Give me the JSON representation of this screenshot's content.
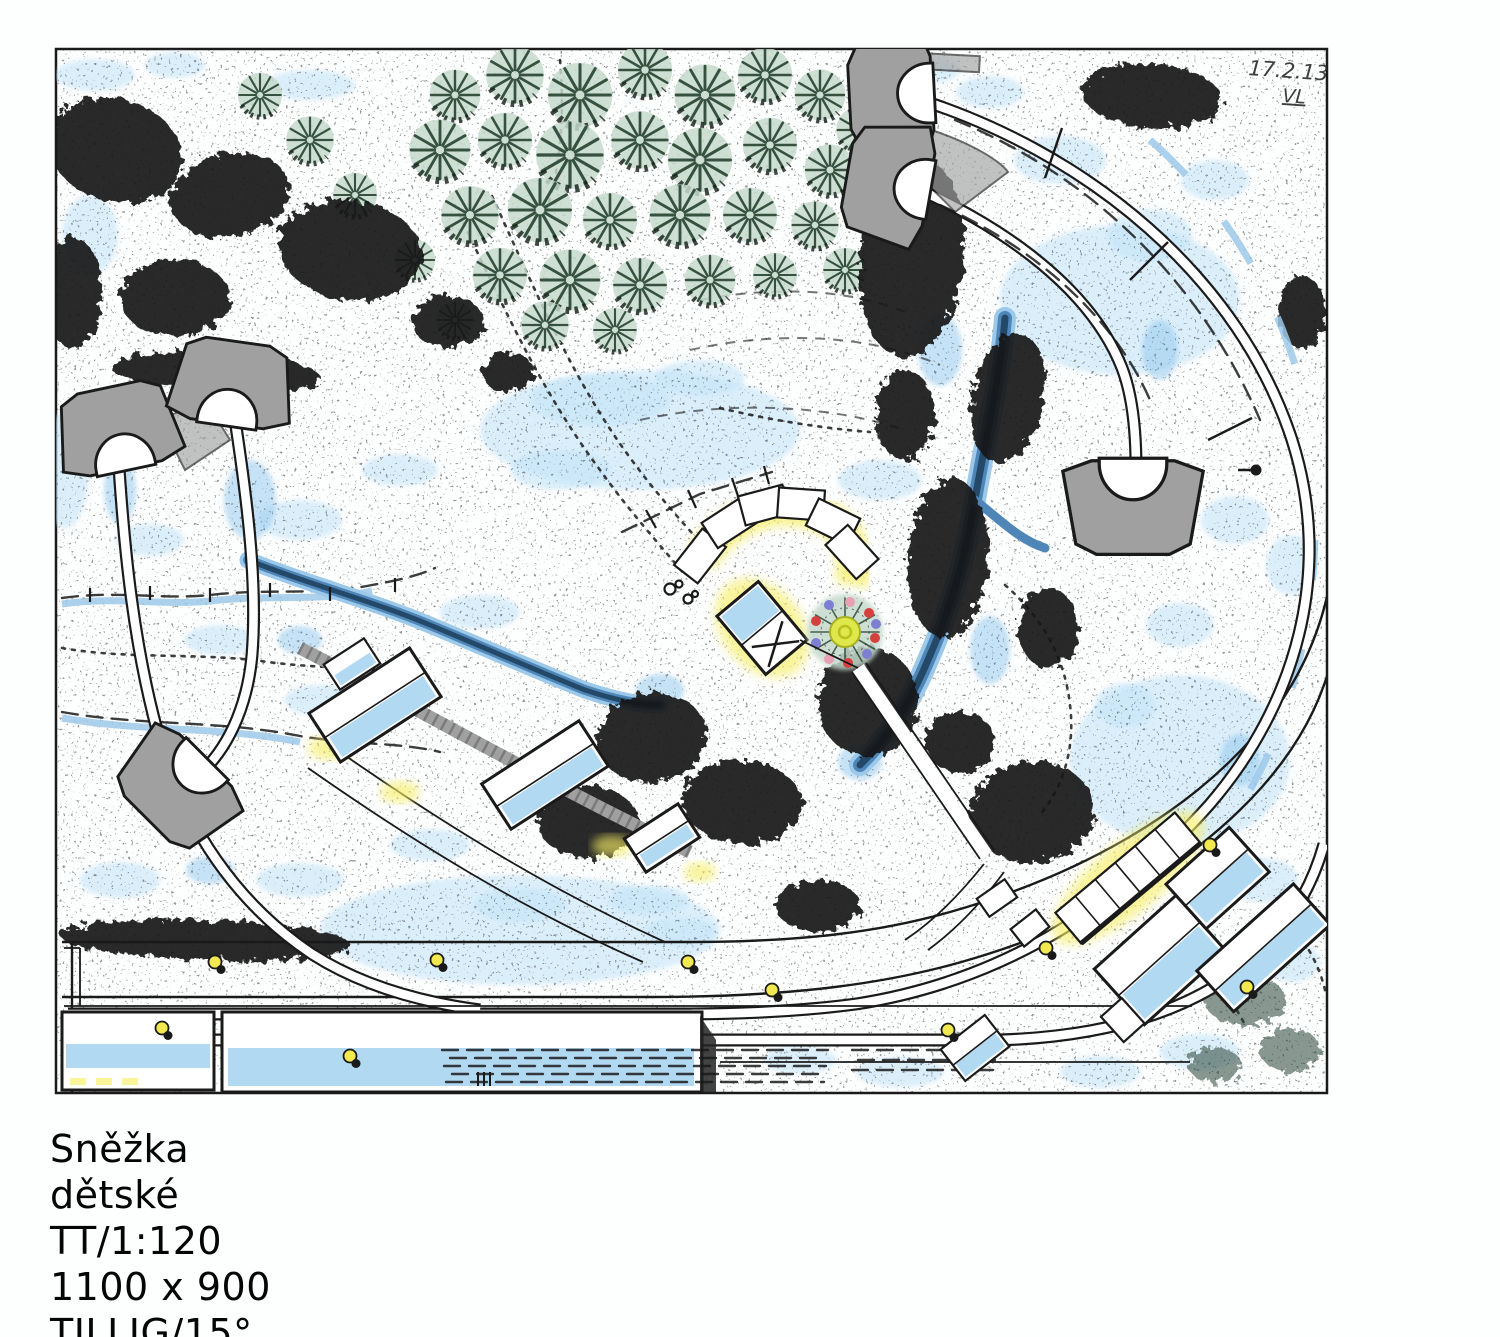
{
  "caption": {
    "title": "Sněžka",
    "category": "dětské",
    "scale": "TT/1:120",
    "dimensions": "1100 x 900",
    "track_system": "TILLIG/15°"
  },
  "plan": {
    "note_date": "17.2.13",
    "note_initials": "VL"
  },
  "colors": {
    "ink": "#1a1a1a",
    "snow_shadow": "#bfe2f7",
    "snow_deep": "#8ec6ee",
    "water_light": "#9cc9ea",
    "water_mid": "#4f86b8",
    "water_dark": "#1e415f",
    "conifer_wash": "#c5d9cc",
    "conifer_line": "#36523f",
    "masonry": "#a0a0a0",
    "roof_blue": "#a5d2f0",
    "glow_yellow": "#f7ee66",
    "lamp_yellow": "#f2e84f",
    "ornament_red": "#d4403e",
    "ornament_violet": "#7d7fd2",
    "ornament_pink": "#e8a0b4",
    "tree_center_yellow": "#dfe84a"
  }
}
